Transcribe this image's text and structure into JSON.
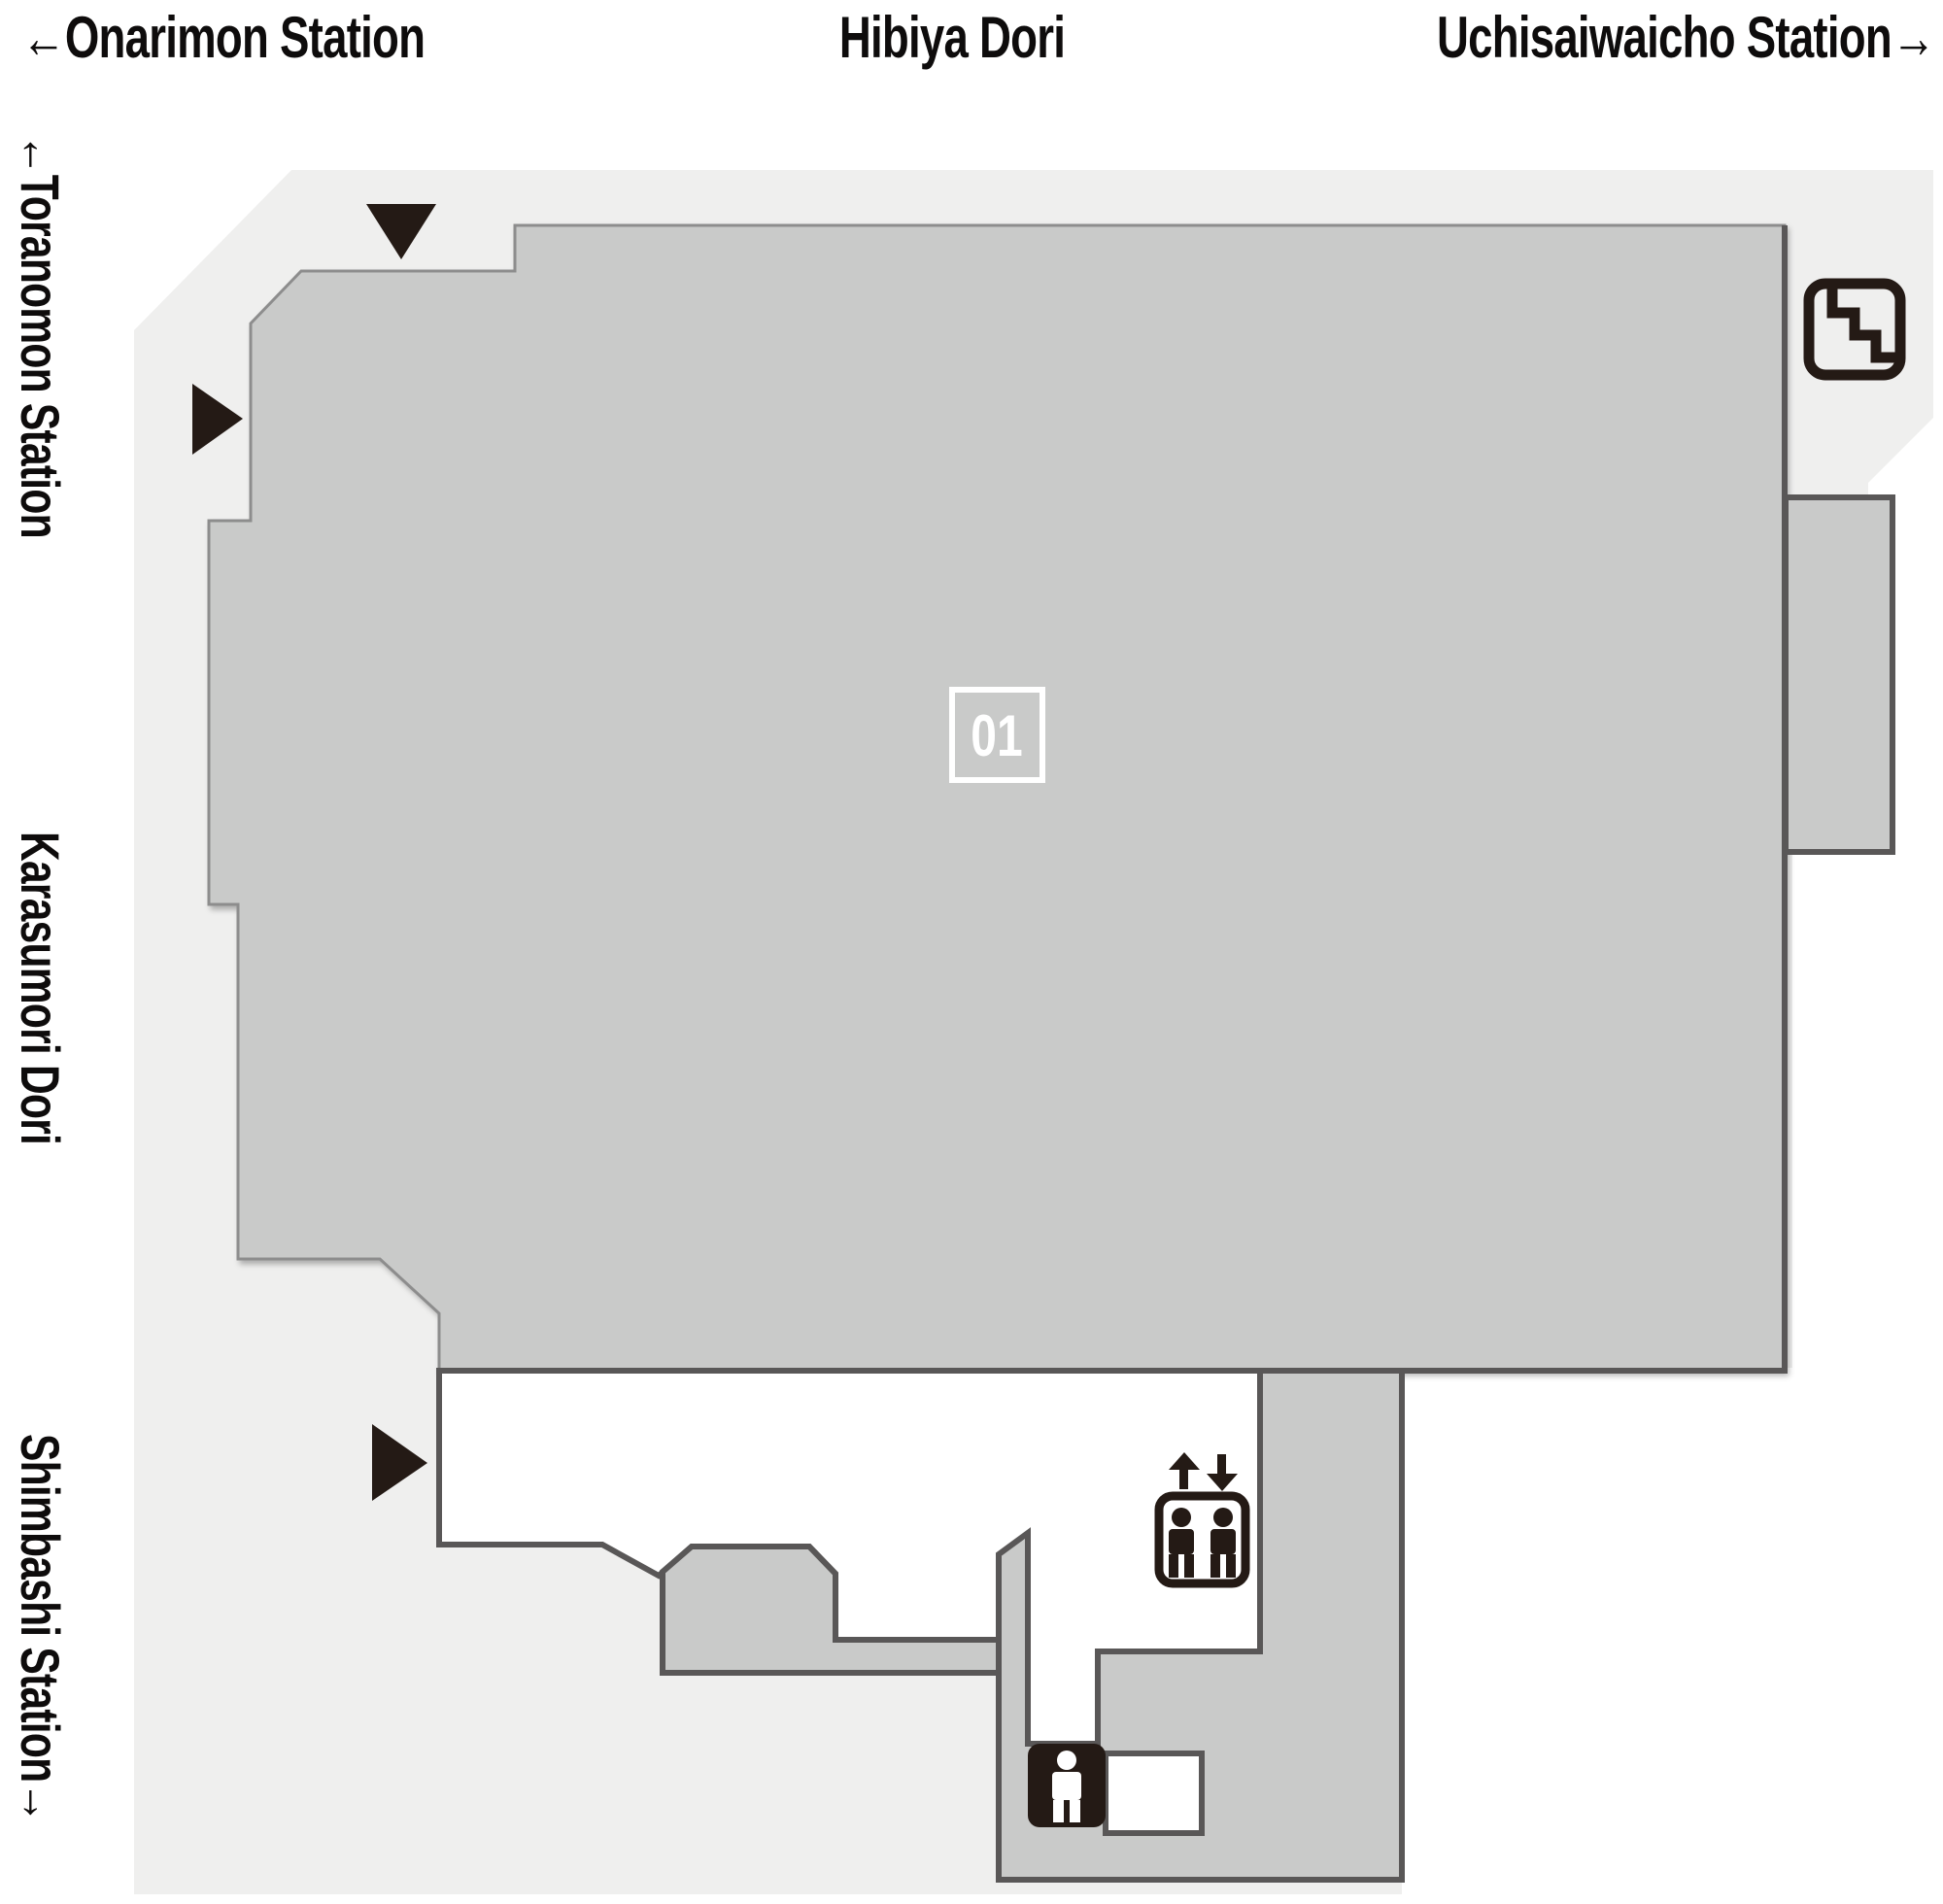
{
  "streets": {
    "top_left": "←Onarimon Station",
    "top_center": "Hibiya Dori",
    "top_right": "Uchisaiwaicho Station→",
    "left_top": "←Toranomon Station",
    "left_middle": "Karasumori Dori",
    "left_bottom": "Shimbashi Station→"
  },
  "map": {
    "area_label": "01",
    "colors": {
      "sidewalk": "#efefee",
      "floor": "#c9cac9",
      "wall": "#595757",
      "edge": "#8d8d8d",
      "icon": "#241a15",
      "area-box": "#ffffff"
    },
    "icons": [
      {
        "name": "stairs-icon"
      },
      {
        "name": "elevator-icon"
      },
      {
        "name": "toilet-icon"
      }
    ],
    "entrance_markers": {
      "count": 3
    }
  }
}
